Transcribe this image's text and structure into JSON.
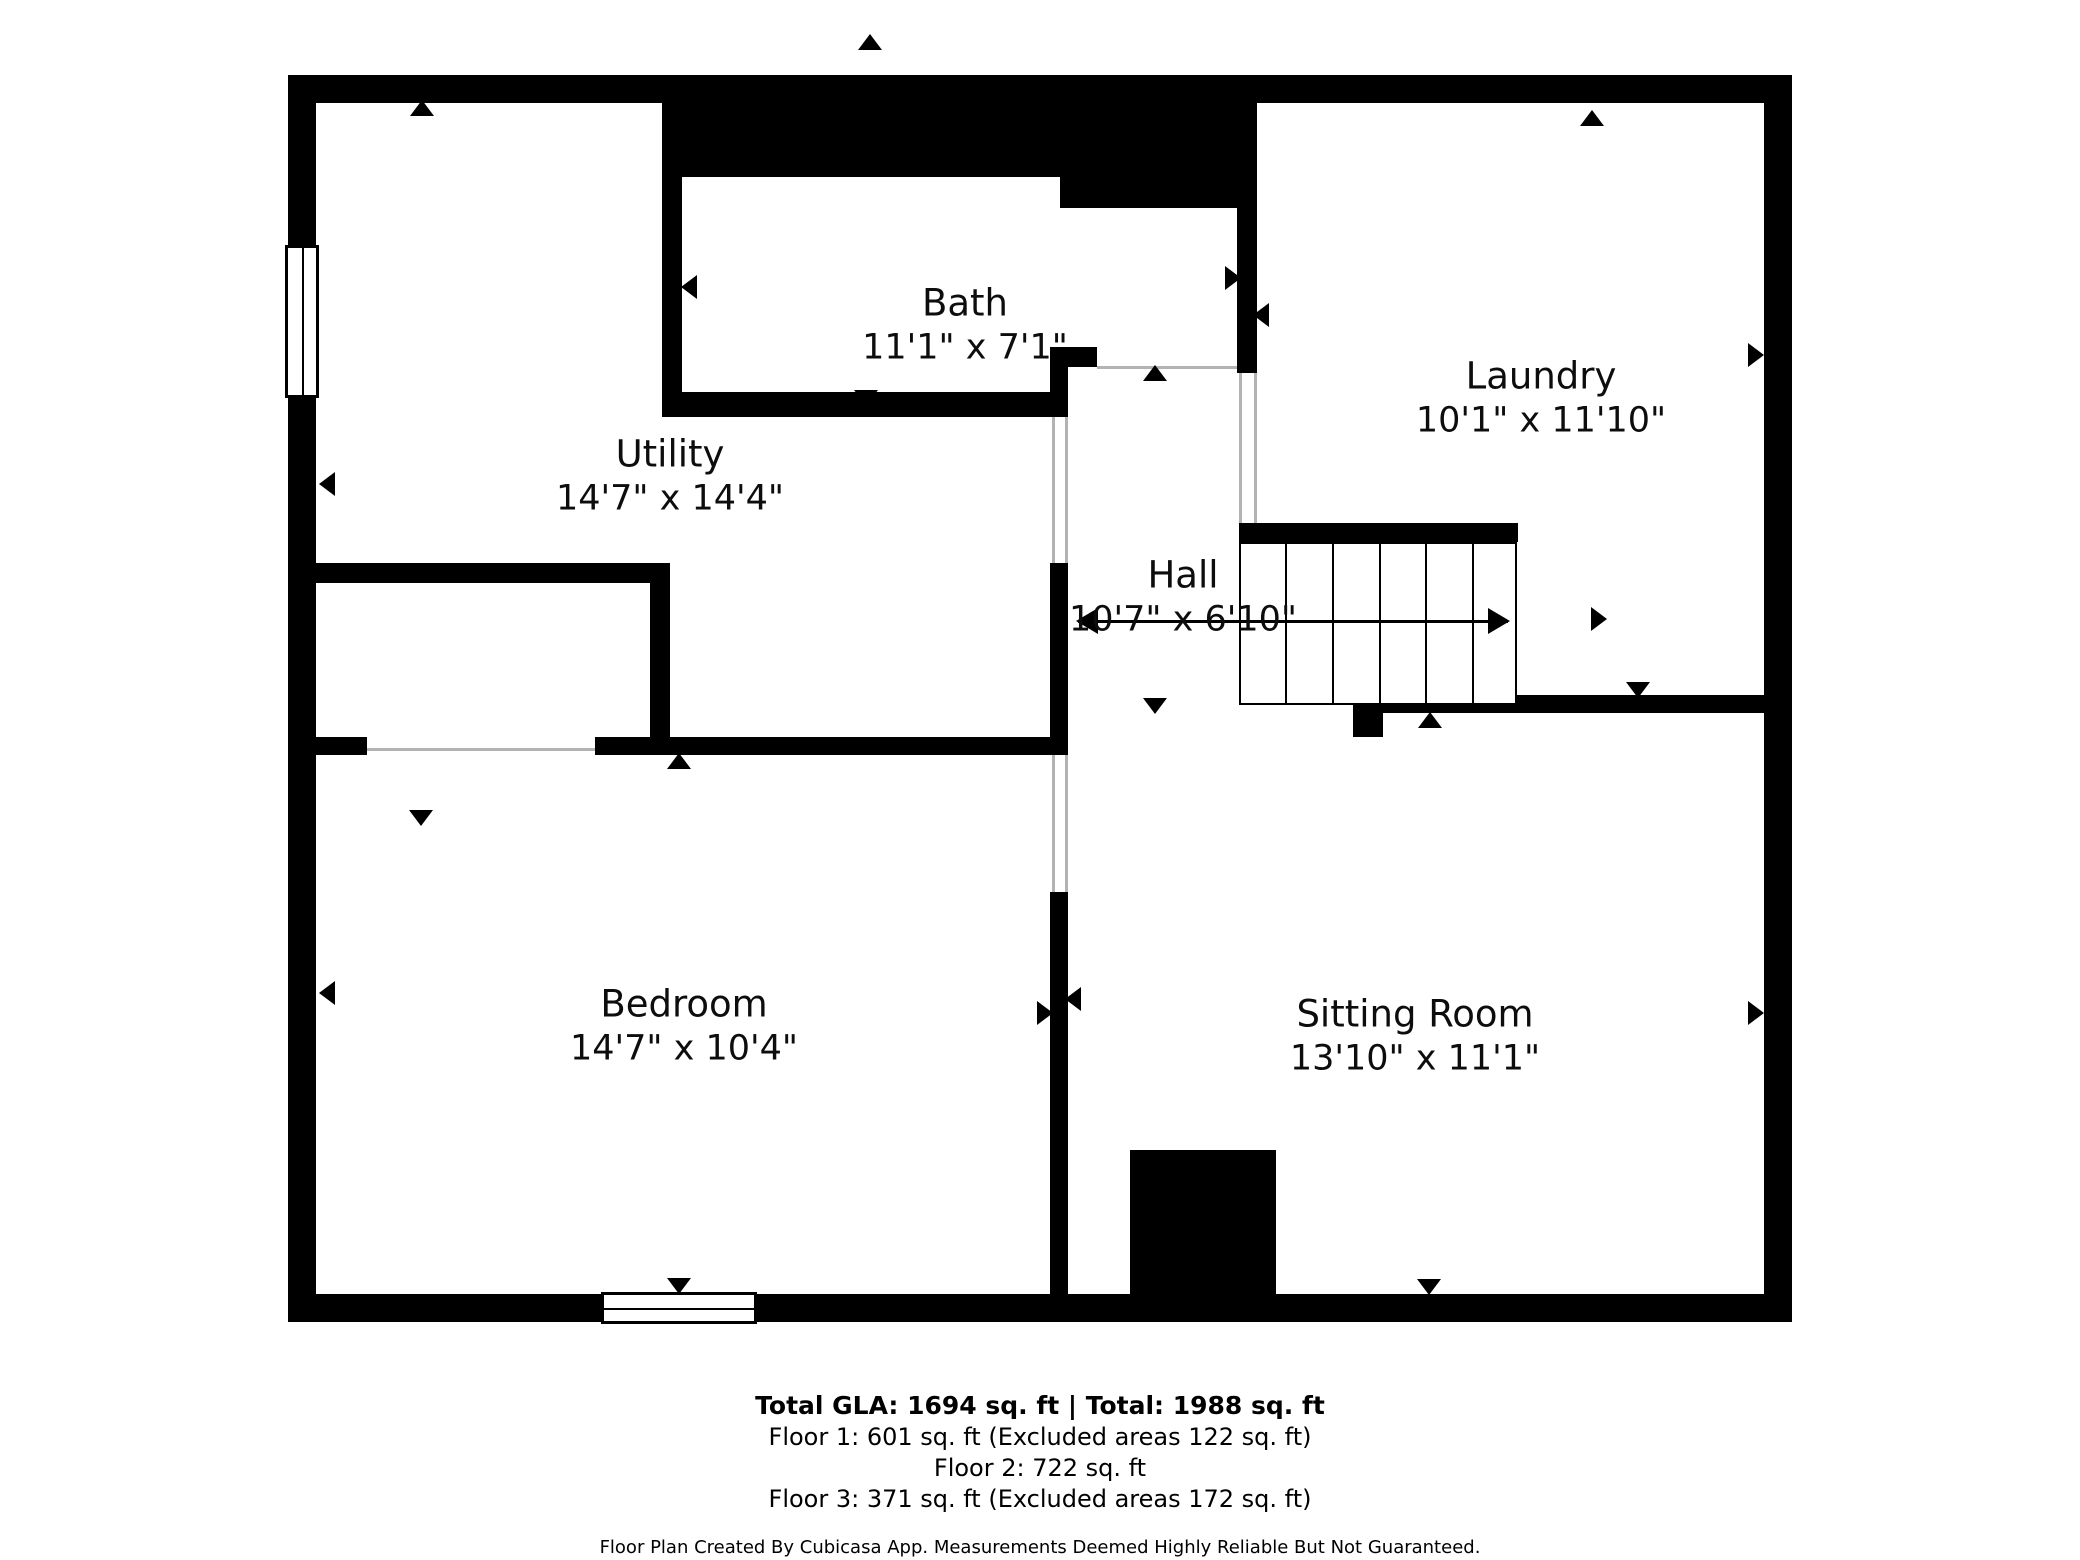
{
  "footer": {
    "total": "Total GLA: 1694 sq. ft | Total: 1988 sq. ft",
    "floor1": "Floor 1: 601 sq. ft (Excluded areas 122 sq. ft)",
    "floor2": "Floor 2: 722 sq. ft",
    "floor3": "Floor 3: 371 sq. ft (Excluded areas 172 sq. ft)",
    "disclaimer": "Floor Plan Created By Cubicasa App. Measurements Deemed Highly Reliable But Not Guaranteed."
  },
  "colors": {
    "wall": "#000000",
    "door_line": "#b3b3b3",
    "background": "#ffffff",
    "text": "#0d0d0d"
  },
  "rooms": [
    {
      "id": "utility",
      "name": "Utility",
      "dims": "14'7\" x 14'4\"",
      "cx": 670,
      "cy": 476
    },
    {
      "id": "bath",
      "name": "Bath",
      "dims": "11'1\" x 7'1\"",
      "cx": 965,
      "cy": 325
    },
    {
      "id": "laundry",
      "name": "Laundry",
      "dims": "10'1\" x 11'10\"",
      "cx": 1541,
      "cy": 398
    },
    {
      "id": "hall",
      "name": "Hall",
      "dims": "10'7\" x 6'10\"",
      "cx": 1183,
      "cy": 597
    },
    {
      "id": "bedroom",
      "name": "Bedroom",
      "dims": "14'7\" x 10'4\"",
      "cx": 684,
      "cy": 1026
    },
    {
      "id": "sitting",
      "name": "Sitting Room",
      "dims": "13'10\" x 11'1\"",
      "cx": 1415,
      "cy": 1036
    }
  ],
  "plan": {
    "walls": [
      {
        "name": "outer-top",
        "x": 288,
        "y": 75,
        "w": 1504,
        "h": 28
      },
      {
        "name": "outer-left-upper",
        "x": 288,
        "y": 75,
        "w": 28,
        "h": 172
      },
      {
        "name": "outer-left-lower",
        "x": 288,
        "y": 398,
        "w": 28,
        "h": 924
      },
      {
        "name": "outer-right",
        "x": 1764,
        "y": 75,
        "w": 28,
        "h": 1247
      },
      {
        "name": "outer-bottom-left",
        "x": 288,
        "y": 1294,
        "w": 313,
        "h": 28
      },
      {
        "name": "outer-bottom-right",
        "x": 757,
        "y": 1294,
        "w": 1035,
        "h": 28
      },
      {
        "name": "mass-over-bath",
        "x": 662,
        "y": 75,
        "w": 398,
        "h": 102
      },
      {
        "name": "mass-over-landing",
        "x": 1060,
        "y": 75,
        "w": 197,
        "h": 133
      },
      {
        "name": "bath-left-wall",
        "x": 662,
        "y": 177,
        "w": 20,
        "h": 240
      },
      {
        "name": "bath-bottom-wall",
        "x": 662,
        "y": 392,
        "w": 390,
        "h": 25
      },
      {
        "name": "bath-stub-vertical",
        "x": 1050,
        "y": 347,
        "w": 18,
        "h": 70
      },
      {
        "name": "bath-stub-horiz",
        "x": 1050,
        "y": 347,
        "w": 47,
        "h": 20
      },
      {
        "name": "laundry-left-wall",
        "x": 1237,
        "y": 208,
        "w": 20,
        "h": 165
      },
      {
        "name": "hall-left-wall",
        "x": 1050,
        "y": 563,
        "w": 18,
        "h": 192
      },
      {
        "name": "bedroom-sitting-divider",
        "x": 1050,
        "y": 892,
        "w": 18,
        "h": 402
      },
      {
        "name": "closet-top-wall",
        "x": 288,
        "y": 563,
        "w": 382,
        "h": 20
      },
      {
        "name": "closet-right-wall",
        "x": 650,
        "y": 563,
        "w": 20,
        "h": 192
      },
      {
        "name": "bedroom-top-stub",
        "x": 316,
        "y": 737,
        "w": 51,
        "h": 18
      },
      {
        "name": "bedroom-top-wall",
        "x": 595,
        "y": 737,
        "w": 473,
        "h": 18
      },
      {
        "name": "stairs-top-bar",
        "x": 1239,
        "y": 523,
        "w": 279,
        "h": 19
      },
      {
        "name": "under-stairs-wall",
        "x": 1353,
        "y": 695,
        "w": 411,
        "h": 18
      },
      {
        "name": "under-stairs-block",
        "x": 1353,
        "y": 713,
        "w": 30,
        "h": 24
      },
      {
        "name": "fireplace",
        "x": 1130,
        "y": 1150,
        "w": 146,
        "h": 144
      }
    ],
    "door_lines": [
      {
        "o": "h",
        "x": 367,
        "y": 748,
        "len": 228
      },
      {
        "o": "h",
        "x": 1097,
        "y": 366,
        "len": 140
      },
      {
        "o": "v",
        "x": 1052,
        "y": 417,
        "len": 146
      },
      {
        "o": "v",
        "x": 1065,
        "y": 417,
        "len": 146
      },
      {
        "o": "v",
        "x": 1052,
        "y": 755,
        "len": 137
      },
      {
        "o": "v",
        "x": 1065,
        "y": 755,
        "len": 137
      },
      {
        "o": "v",
        "x": 1239,
        "y": 373,
        "len": 150
      },
      {
        "o": "v",
        "x": 1254,
        "y": 373,
        "len": 150
      }
    ],
    "windows": [
      {
        "name": "window-left-wall",
        "o": "v",
        "x": 285,
        "y": 245,
        "w": 34,
        "h": 153
      },
      {
        "name": "window-bottom-wall",
        "o": "h",
        "x": 601,
        "y": 1292,
        "w": 156,
        "h": 32
      }
    ],
    "stairs": {
      "x": 1239,
      "y": 542,
      "w": 278,
      "h": 163,
      "treads": [
        1285,
        1332,
        1379,
        1425,
        1472
      ]
    },
    "stair_arrow": {
      "x1": 1078,
      "x2": 1508,
      "y": 621
    },
    "markers": [
      {
        "d": "up",
        "x": 870,
        "y": 42
      },
      {
        "d": "up",
        "x": 422,
        "y": 108
      },
      {
        "d": "left",
        "x": 327,
        "y": 484
      },
      {
        "d": "left",
        "x": 689,
        "y": 287
      },
      {
        "d": "down",
        "x": 866,
        "y": 398
      },
      {
        "d": "up",
        "x": 1155,
        "y": 373
      },
      {
        "d": "right",
        "x": 1233,
        "y": 278
      },
      {
        "d": "left",
        "x": 1261,
        "y": 315
      },
      {
        "d": "up",
        "x": 1592,
        "y": 118
      },
      {
        "d": "right",
        "x": 1756,
        "y": 355
      },
      {
        "d": "right",
        "x": 1599,
        "y": 619
      },
      {
        "d": "down",
        "x": 1638,
        "y": 690
      },
      {
        "d": "up",
        "x": 1430,
        "y": 720
      },
      {
        "d": "down",
        "x": 1155,
        "y": 706
      },
      {
        "d": "up",
        "x": 679,
        "y": 761
      },
      {
        "d": "down",
        "x": 421,
        "y": 818
      },
      {
        "d": "down",
        "x": 679,
        "y": 1286
      },
      {
        "d": "down",
        "x": 1429,
        "y": 1287
      },
      {
        "d": "left",
        "x": 327,
        "y": 993
      },
      {
        "d": "right",
        "x": 1045,
        "y": 1013
      },
      {
        "d": "left",
        "x": 1073,
        "y": 999
      },
      {
        "d": "right",
        "x": 1756,
        "y": 1013
      }
    ]
  }
}
